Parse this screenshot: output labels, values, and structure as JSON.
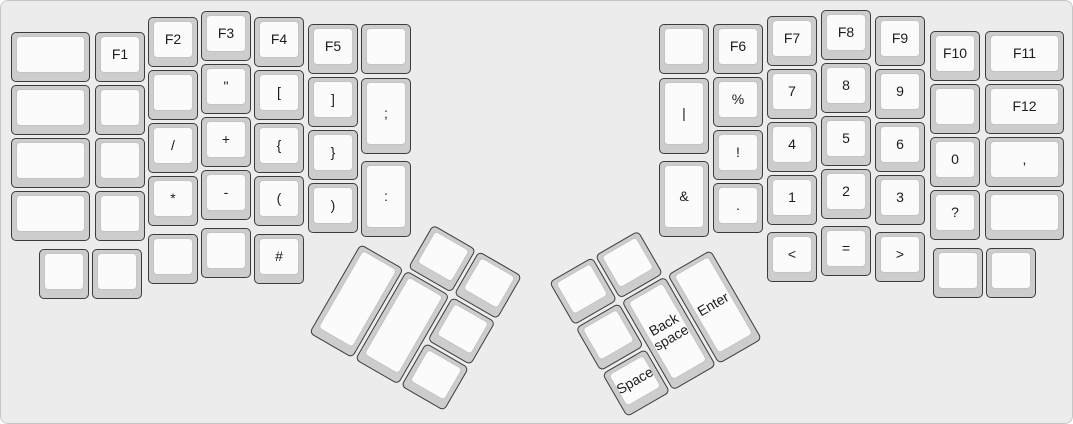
{
  "colors": {
    "canvas_bg": "#ececec",
    "canvas_border": "#c6c6c6",
    "key_side": "#cdcdcd",
    "key_top": "#fbfbfb",
    "key_top_border": "#c4c4c4",
    "key_border": "#3c3c3c",
    "label_color": "#1c1c1c"
  },
  "keyboard": {
    "groups": {
      "left_main": {
        "rotation": 0,
        "origin": [
          0,
          0
        ],
        "keys": [
          {
            "name": "blank",
            "label": "",
            "x": 10,
            "y": 31,
            "w": 79,
            "h": 50
          },
          {
            "name": "f1",
            "label": "F1",
            "x": 94,
            "y": 31,
            "w": 50,
            "h": 50
          },
          {
            "name": "f2",
            "label": "F2",
            "x": 147,
            "y": 16,
            "w": 50,
            "h": 50
          },
          {
            "name": "f3",
            "label": "F3",
            "x": 200,
            "y": 10,
            "w": 50,
            "h": 50
          },
          {
            "name": "f4",
            "label": "F4",
            "x": 253,
            "y": 16,
            "w": 50,
            "h": 50
          },
          {
            "name": "f5",
            "label": "F5",
            "x": 307,
            "y": 23,
            "w": 50,
            "h": 50
          },
          {
            "name": "blank",
            "label": "",
            "x": 360,
            "y": 23,
            "w": 50,
            "h": 50
          },
          {
            "name": "blank",
            "label": "",
            "x": 10,
            "y": 84,
            "w": 79,
            "h": 50
          },
          {
            "name": "blank",
            "label": "",
            "x": 94,
            "y": 84,
            "w": 50,
            "h": 50
          },
          {
            "name": "blank",
            "label": "",
            "x": 147,
            "y": 69,
            "w": 50,
            "h": 50
          },
          {
            "name": "double-quote",
            "label": "\"",
            "x": 200,
            "y": 63,
            "w": 50,
            "h": 50
          },
          {
            "name": "bracket-open",
            "label": "[",
            "x": 253,
            "y": 69,
            "w": 50,
            "h": 50
          },
          {
            "name": "bracket-close",
            "label": "]",
            "x": 307,
            "y": 76,
            "w": 50,
            "h": 50
          },
          {
            "name": "semicolon",
            "label": ";",
            "x": 360,
            "y": 77,
            "w": 50,
            "h": 76
          },
          {
            "name": "blank",
            "label": "",
            "x": 10,
            "y": 137,
            "w": 79,
            "h": 50
          },
          {
            "name": "blank",
            "label": "",
            "x": 94,
            "y": 137,
            "w": 50,
            "h": 50
          },
          {
            "name": "slash",
            "label": "/",
            "x": 147,
            "y": 122,
            "w": 50,
            "h": 50
          },
          {
            "name": "plus",
            "label": "+",
            "x": 200,
            "y": 116,
            "w": 50,
            "h": 50
          },
          {
            "name": "brace-open",
            "label": "{",
            "x": 253,
            "y": 122,
            "w": 50,
            "h": 50
          },
          {
            "name": "brace-close",
            "label": "}",
            "x": 307,
            "y": 129,
            "w": 50,
            "h": 50
          },
          {
            "name": "blank",
            "label": "",
            "x": 10,
            "y": 190,
            "w": 79,
            "h": 50
          },
          {
            "name": "blank",
            "label": "",
            "x": 94,
            "y": 190,
            "w": 50,
            "h": 50
          },
          {
            "name": "asterisk",
            "label": "*",
            "x": 147,
            "y": 175,
            "w": 50,
            "h": 50
          },
          {
            "name": "minus",
            "label": "-",
            "x": 200,
            "y": 169,
            "w": 50,
            "h": 50
          },
          {
            "name": "paren-open",
            "label": "(",
            "x": 253,
            "y": 175,
            "w": 50,
            "h": 50
          },
          {
            "name": "paren-close",
            "label": ")",
            "x": 307,
            "y": 182,
            "w": 50,
            "h": 50
          },
          {
            "name": "colon",
            "label": ":",
            "x": 360,
            "y": 160,
            "w": 50,
            "h": 76
          },
          {
            "name": "blank",
            "label": "",
            "x": 38,
            "y": 248,
            "w": 50,
            "h": 50
          },
          {
            "name": "blank",
            "label": "",
            "x": 91,
            "y": 248,
            "w": 50,
            "h": 50
          },
          {
            "name": "blank",
            "label": "",
            "x": 147,
            "y": 233,
            "w": 50,
            "h": 50
          },
          {
            "name": "blank",
            "label": "",
            "x": 200,
            "y": 227,
            "w": 50,
            "h": 50
          },
          {
            "name": "hash",
            "label": "#",
            "x": 253,
            "y": 233,
            "w": 50,
            "h": 50
          }
        ]
      },
      "left_thumb": {
        "rotation": 30,
        "origin": [
          386,
          197
        ],
        "keys": [
          {
            "name": "blank",
            "label": "",
            "x": 53,
            "y": 0,
            "w": 50,
            "h": 50
          },
          {
            "name": "blank",
            "label": "",
            "x": 106,
            "y": 0,
            "w": 50,
            "h": 50
          },
          {
            "name": "blank",
            "label": "",
            "x": 0,
            "y": 53,
            "w": 50,
            "h": 103
          },
          {
            "name": "blank",
            "label": "",
            "x": 53,
            "y": 53,
            "w": 50,
            "h": 103
          },
          {
            "name": "blank",
            "label": "",
            "x": 106,
            "y": 53,
            "w": 50,
            "h": 50
          },
          {
            "name": "blank",
            "label": "",
            "x": 106,
            "y": 106,
            "w": 50,
            "h": 50
          }
        ]
      },
      "right_thumb": {
        "rotation": -30,
        "origin": [
          548,
          281
        ],
        "keys": [
          {
            "name": "blank",
            "label": "",
            "x": 0,
            "y": 0,
            "w": 50,
            "h": 50
          },
          {
            "name": "blank",
            "label": "",
            "x": 53,
            "y": 0,
            "w": 50,
            "h": 50
          },
          {
            "name": "blank",
            "label": "",
            "x": 0,
            "y": 53,
            "w": 50,
            "h": 50
          },
          {
            "name": "space",
            "label": "Space",
            "x": 0,
            "y": 106,
            "w": 50,
            "h": 50
          },
          {
            "name": "backspace",
            "label": "Back space",
            "x": 53,
            "y": 53,
            "w": 50,
            "h": 103
          },
          {
            "name": "enter",
            "label": "Enter",
            "x": 106,
            "y": 53,
            "w": 50,
            "h": 103
          }
        ]
      },
      "right_main": {
        "rotation": 0,
        "origin": [
          0,
          0
        ],
        "keys": [
          {
            "name": "blank",
            "label": "",
            "x": 658,
            "y": 23,
            "w": 50,
            "h": 50
          },
          {
            "name": "f6",
            "label": "F6",
            "x": 712,
            "y": 23,
            "w": 50,
            "h": 50
          },
          {
            "name": "f7",
            "label": "F7",
            "x": 766,
            "y": 15,
            "w": 50,
            "h": 50
          },
          {
            "name": "f8",
            "label": "F8",
            "x": 820,
            "y": 9,
            "w": 50,
            "h": 50
          },
          {
            "name": "f9",
            "label": "F9",
            "x": 874,
            "y": 15,
            "w": 50,
            "h": 50
          },
          {
            "name": "f10",
            "label": "F10",
            "x": 929,
            "y": 30,
            "w": 50,
            "h": 50
          },
          {
            "name": "f11",
            "label": "F11",
            "x": 984,
            "y": 30,
            "w": 79,
            "h": 50
          },
          {
            "name": "pipe",
            "label": "|",
            "x": 658,
            "y": 77,
            "w": 50,
            "h": 76
          },
          {
            "name": "percent",
            "label": "%",
            "x": 712,
            "y": 76,
            "w": 50,
            "h": 50
          },
          {
            "name": "7",
            "label": "7",
            "x": 766,
            "y": 68,
            "w": 50,
            "h": 50
          },
          {
            "name": "8",
            "label": "8",
            "x": 820,
            "y": 62,
            "w": 50,
            "h": 50
          },
          {
            "name": "9",
            "label": "9",
            "x": 874,
            "y": 68,
            "w": 50,
            "h": 50
          },
          {
            "name": "blank",
            "label": "",
            "x": 929,
            "y": 83,
            "w": 50,
            "h": 50
          },
          {
            "name": "f12",
            "label": "F12",
            "x": 984,
            "y": 83,
            "w": 79,
            "h": 50
          },
          {
            "name": "exclamation",
            "label": "!",
            "x": 712,
            "y": 129,
            "w": 50,
            "h": 50
          },
          {
            "name": "4",
            "label": "4",
            "x": 766,
            "y": 121,
            "w": 50,
            "h": 50
          },
          {
            "name": "5",
            "label": "5",
            "x": 820,
            "y": 115,
            "w": 50,
            "h": 50
          },
          {
            "name": "6",
            "label": "6",
            "x": 874,
            "y": 121,
            "w": 50,
            "h": 50
          },
          {
            "name": "0",
            "label": "0",
            "x": 929,
            "y": 136,
            "w": 50,
            "h": 50
          },
          {
            "name": "comma",
            "label": ",",
            "x": 984,
            "y": 136,
            "w": 79,
            "h": 50
          },
          {
            "name": "ampersand",
            "label": "&",
            "x": 658,
            "y": 160,
            "w": 50,
            "h": 76
          },
          {
            "name": "period",
            "label": ".",
            "x": 712,
            "y": 182,
            "w": 50,
            "h": 50
          },
          {
            "name": "1",
            "label": "1",
            "x": 766,
            "y": 174,
            "w": 50,
            "h": 50
          },
          {
            "name": "2",
            "label": "2",
            "x": 820,
            "y": 168,
            "w": 50,
            "h": 50
          },
          {
            "name": "3",
            "label": "3",
            "x": 874,
            "y": 174,
            "w": 50,
            "h": 50
          },
          {
            "name": "question",
            "label": "?",
            "x": 929,
            "y": 189,
            "w": 50,
            "h": 50
          },
          {
            "name": "blank",
            "label": "",
            "x": 984,
            "y": 189,
            "w": 79,
            "h": 50
          },
          {
            "name": "less-than",
            "label": "<",
            "x": 766,
            "y": 231,
            "w": 50,
            "h": 50
          },
          {
            "name": "equals",
            "label": "=",
            "x": 820,
            "y": 225,
            "w": 50,
            "h": 50
          },
          {
            "name": "greater-than",
            "label": ">",
            "x": 874,
            "y": 231,
            "w": 50,
            "h": 50
          },
          {
            "name": "blank",
            "label": "",
            "x": 932,
            "y": 247,
            "w": 50,
            "h": 50
          },
          {
            "name": "blank",
            "label": "",
            "x": 985,
            "y": 247,
            "w": 50,
            "h": 50
          }
        ]
      }
    }
  }
}
